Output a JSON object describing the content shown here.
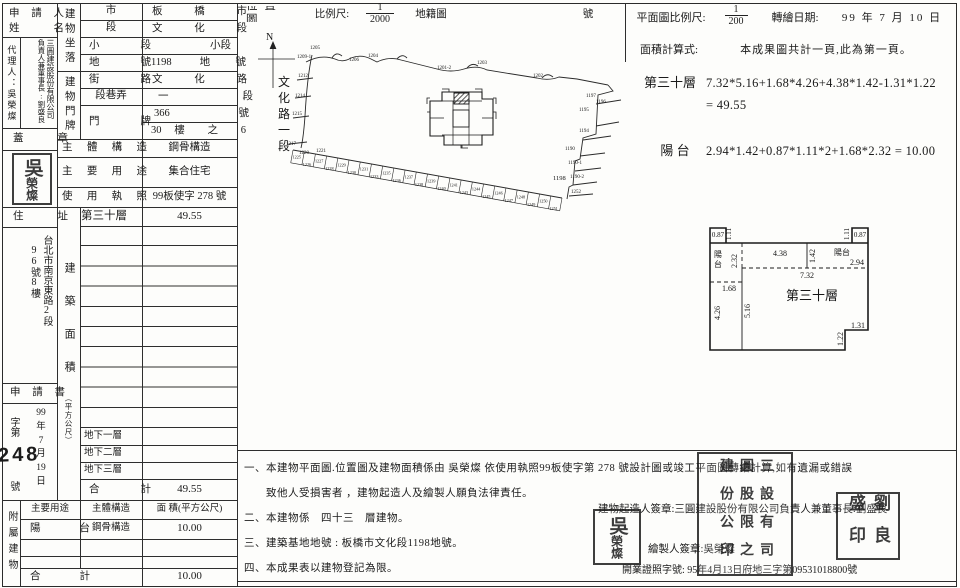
{
  "form": {
    "applicant_line1": "申 請 人",
    "applicant_line2": "姓 名",
    "agent_col": "代理人：吳榮燦",
    "company_col1": "三圓建設股份有限公司",
    "company_col2": "負責人兼董事長:劉盛良",
    "seal_label": "蓋 章",
    "site_group_label": "建物坐落",
    "site_rows": [
      {
        "label": "市",
        "value": "板 橋 市"
      },
      {
        "label": "段",
        "value": "文 化 段"
      },
      {
        "label": "小 段",
        "value": "小段"
      },
      {
        "label": "地 號",
        "value": "1198 地號"
      }
    ],
    "door_group_label": "建物門牌",
    "door_rows": [
      {
        "label": "街 路",
        "value": "文 化 路"
      },
      {
        "label": "段巷弄",
        "value": "一 段"
      }
    ],
    "door_label": "門 牌",
    "door_no": "366 號",
    "door_no2": "30 樓 之 6",
    "structure_label": "主 體 構 造",
    "structure_value": "鋼骨構造",
    "use_label": "主 要 用 途",
    "use_value": "集合住宅",
    "license_label": "使 用 執 照",
    "license_value": "99板使字 278 號",
    "address_label": "住 址",
    "address_col1": "台北市南京東路2段",
    "address_col2": "96號8樓",
    "application_label": "申 請 書",
    "app_no_prefix": "字第",
    "app_no_suffix": "號",
    "app_no_number": "248",
    "app_date_parts": [
      "99",
      "年",
      "7",
      "月",
      "19",
      "日"
    ],
    "area_group_label": "建築面積",
    "area_group_unit": "（平方公尺）",
    "floor_row": {
      "floor": "第三十層",
      "value": "49.55"
    },
    "basement_rows": [
      "地下一層",
      "地下二層",
      "地下三層"
    ],
    "total_label": "合 計",
    "total_value": "49.55",
    "annex_group_label": "附屬建物",
    "annex_headers": [
      "主要用途",
      "主體構造",
      "面 積(平方公尺)"
    ],
    "annex_row": {
      "use": "陽 台",
      "structure": "鋼骨構造",
      "area": "10.00"
    },
    "annex_total_label": "合 計",
    "annex_total_value": "10.00"
  },
  "location_map": {
    "title": "位 置 圖",
    "scale_label": "比例尺:",
    "scale_num": "1",
    "scale_den": "2000",
    "map_type": "地籍圖",
    "number_suffix": "號",
    "north_label": "N",
    "road_name": "文化路一段",
    "labels": [
      {
        "t": "1205",
        "x": 73,
        "y": 21,
        "s": 5
      },
      {
        "t": "1209-1",
        "x": 60,
        "y": 30,
        "s": 5
      },
      {
        "t": "1206",
        "x": 112,
        "y": 33,
        "s": 5
      },
      {
        "t": "1204",
        "x": 131,
        "y": 29,
        "s": 5
      },
      {
        "t": "1201-2",
        "x": 200,
        "y": 41,
        "s": 5
      },
      {
        "t": "1203",
        "x": 240,
        "y": 36,
        "s": 5
      },
      {
        "t": "1202",
        "x": 296,
        "y": 49,
        "s": 5
      },
      {
        "t": "1212",
        "x": 61,
        "y": 49,
        "s": 5
      },
      {
        "t": "1214",
        "x": 58,
        "y": 69,
        "s": 5
      },
      {
        "t": "1215",
        "x": 55,
        "y": 87,
        "s": 5
      },
      {
        "t": "1217",
        "x": 49,
        "y": 117,
        "s": 5
      },
      {
        "t": "1220",
        "x": 62,
        "y": 126,
        "s": 5
      },
      {
        "t": "1221",
        "x": 79,
        "y": 124,
        "s": 5
      },
      {
        "t": "1197",
        "x": 349,
        "y": 69,
        "s": 5
      },
      {
        "t": "1196",
        "x": 359,
        "y": 75,
        "s": 5
      },
      {
        "t": "1195",
        "x": 342,
        "y": 83,
        "s": 5
      },
      {
        "t": "1194",
        "x": 342,
        "y": 104,
        "s": 5
      },
      {
        "t": "1190",
        "x": 328,
        "y": 122,
        "s": 5
      },
      {
        "t": "1190-1",
        "x": 331,
        "y": 136,
        "s": 5
      },
      {
        "t": "1190-2",
        "x": 333,
        "y": 150,
        "s": 5
      },
      {
        "t": "1198",
        "x": 316,
        "y": 152,
        "s": 6.5
      },
      {
        "t": "1252",
        "x": 334,
        "y": 165,
        "s": 5
      }
    ],
    "comb_labels": [
      "1225",
      "1226",
      "1227",
      "1228",
      "1229",
      "1230",
      "1231",
      "1233",
      "1235",
      "1236",
      "1237",
      "1238",
      "1239",
      "1240",
      "1241",
      "1243",
      "1244",
      "1245",
      "1246",
      "1247",
      "1248",
      "1249",
      "1250",
      "1251"
    ]
  },
  "floor_plan": {
    "scale_label": "平面圖比例尺:",
    "scale_num": "1",
    "scale_den": "200",
    "date_label": "轉繪日期:",
    "date_value": "99 年  7  月  10 日",
    "calc_label": "面積計算式:",
    "calc_note": "本成果圖共計一頁,此為第一頁。",
    "main_floor_label": "第三十層",
    "main_formula": "7.32*5.16+1.68*4.26+4.38*1.42-1.31*1.22",
    "main_result": "= 49.55",
    "balcony_label": "陽  台",
    "balcony_formula": "2.94*1.42+0.87*1.11*2+1.68*2.32 = 10.00",
    "labels": [
      {
        "t": "0.87",
        "x": 58,
        "y": 27,
        "s": 7,
        "a": "middle"
      },
      {
        "t": "1.11",
        "x": 71,
        "y": 30,
        "s": 7,
        "r": -90
      },
      {
        "t": "1.11",
        "x": 189,
        "y": 30,
        "s": 7,
        "r": -90
      },
      {
        "t": "0.87",
        "x": 200,
        "y": 27,
        "s": 7,
        "a": "middle"
      },
      {
        "t": "4.38",
        "x": 120,
        "y": 46,
        "s": 8,
        "a": "middle"
      },
      {
        "t": "1.42",
        "x": 155,
        "y": 53,
        "s": 8,
        "r": -90
      },
      {
        "t": "陽台",
        "x": 174,
        "y": 45,
        "s": 8
      },
      {
        "t": "2.94",
        "x": 190,
        "y": 55,
        "s": 8
      },
      {
        "t": "陽",
        "x": 54,
        "y": 47,
        "s": 8
      },
      {
        "t": "台",
        "x": 54,
        "y": 57,
        "s": 8
      },
      {
        "t": "2.32",
        "x": 77,
        "y": 58,
        "s": 8,
        "r": -90
      },
      {
        "t": "1.68",
        "x": 62,
        "y": 81,
        "s": 8
      },
      {
        "t": "7.32",
        "x": 140,
        "y": 68,
        "s": 8
      },
      {
        "t": "第三十層",
        "x": 126,
        "y": 90,
        "s": 13
      },
      {
        "t": "4.26",
        "x": 60,
        "y": 110,
        "s": 8,
        "r": -90
      },
      {
        "t": "5.16",
        "x": 90,
        "y": 108,
        "s": 8,
        "r": -90
      },
      {
        "t": "1.31",
        "x": 191,
        "y": 118,
        "s": 8
      },
      {
        "t": "1.22",
        "x": 183,
        "y": 136,
        "s": 8,
        "r": -90
      }
    ]
  },
  "notes": {
    "items": [
      "一、本建物平面圖.位置圖及建物面積係由 吳榮燦 依使用執照99板使字第 278 號設計圖或竣工平面圖轉繪計算,如有遺漏或錯誤",
      "　　致他人受損害者 ，建物起造人及繪製人願負法律責任。",
      "二、本建物係　四十三　層建物。",
      "三、建築基地地號 : 板橋市文化段1198地號。",
      "四、本成果表以建物登記為限。"
    ],
    "builder_sign": "建物起造人簽章:三圓建設股份有限公司負責人兼董事長:劉盛良",
    "drafter_sign": "繪製人簽章:吳榮燦",
    "license_line": "開業證照字號: 95年4月13日府地三字第09531018800號"
  },
  "stamps": {
    "company_seal_cols": [
      "三圓建",
      "設股份",
      "有限公",
      "司之印"
    ],
    "liu_seal_cols": [
      "劉盛",
      "良印"
    ],
    "wu_seal_right": "吳",
    "wu_seal_left": "榮燦"
  }
}
